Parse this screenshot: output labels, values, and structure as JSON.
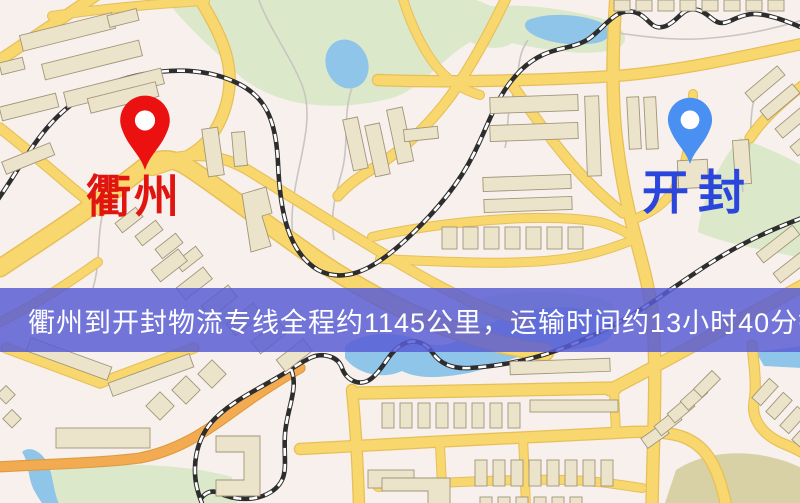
{
  "window": {
    "width": 800,
    "height": 503,
    "kind": "map-route-screenshot"
  },
  "banner": {
    "text": "衢州到开封物流专线全程约1145公里，运输时间约13小时40分钟.",
    "bg_color": "#585cd4",
    "text_color": "#ffffff"
  },
  "route": {
    "origin": "衢州",
    "destination": "开封",
    "service": "物流专线",
    "distance": "约1145公里",
    "duration": "约13小时40分钟"
  },
  "markers": {
    "origin": {
      "name": "衢州",
      "pin_color": "#ea1110",
      "label_color": "#e0150f",
      "pin_style": "teardrop"
    },
    "destination": {
      "name": "开封",
      "pin_color": "#4a8ff2",
      "label_color": "#2a46dd",
      "pin_style": "teardrop"
    }
  },
  "map": {
    "colors": {
      "background": "#f7f0ec",
      "road_fill": "#f8d76e",
      "road_casing": "#e7bf58",
      "road_orange": "#f3ab51",
      "building_fill": "#ece4ca",
      "building_stroke": "#a1957a",
      "park_green": "#dbe8c9",
      "water_blue": "#8fc5e9",
      "railway_dark": "#2d2d2d",
      "hill_tan": "#d7d1a5"
    }
  }
}
